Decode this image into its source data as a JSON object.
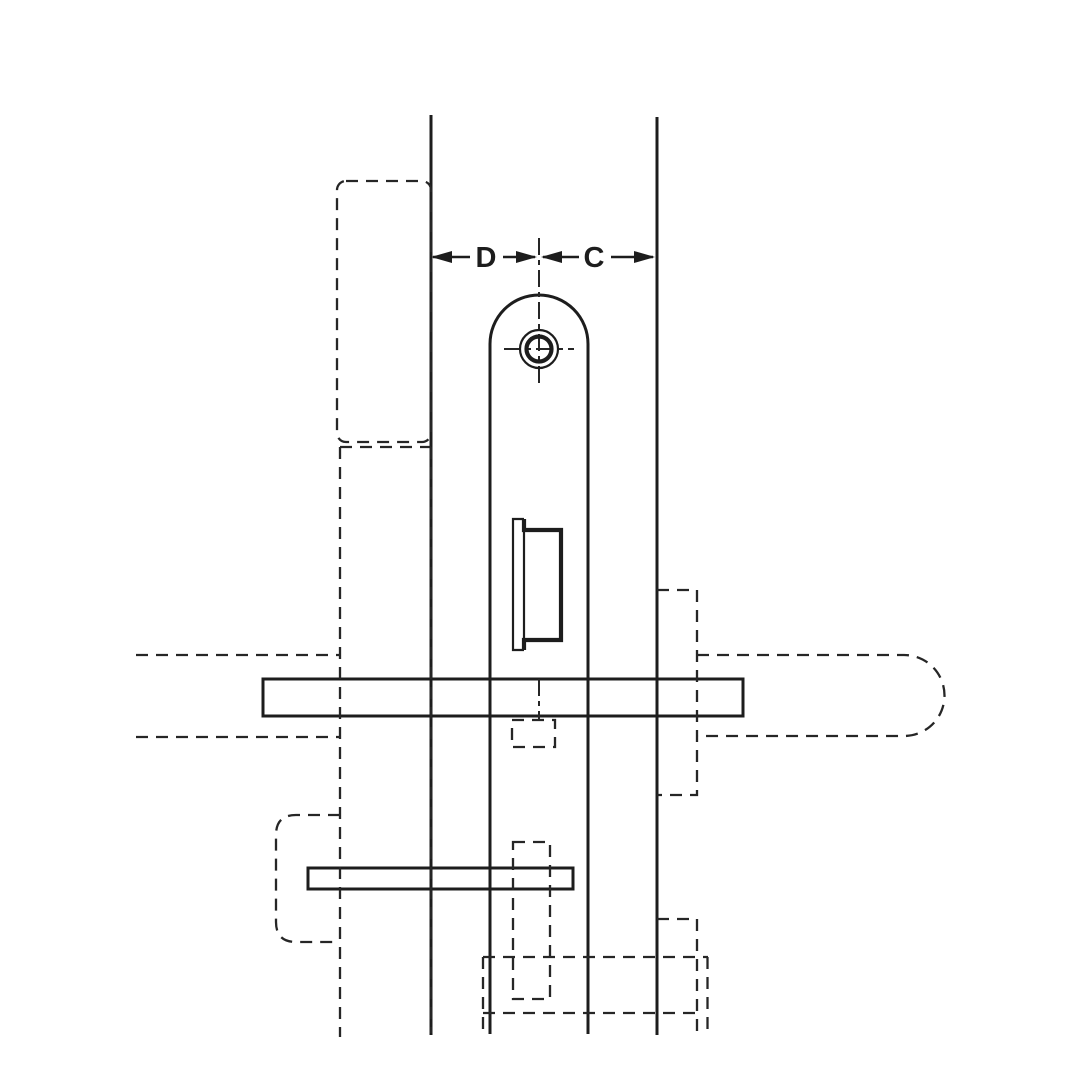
{
  "diagram": {
    "type": "technical-line-drawing",
    "subject": "mortise-lock-faceplate-installation-side-view",
    "background_color": "#ffffff",
    "line_color": "#1d1d1d",
    "dimensions": {
      "left": {
        "label": "D",
        "meaning": "distance from left door edge line to lock centerline"
      },
      "right": {
        "label": "C",
        "meaning": "distance from lock centerline to right door edge line"
      }
    },
    "labels": {
      "dim_left": "D",
      "dim_right": "C"
    }
  }
}
